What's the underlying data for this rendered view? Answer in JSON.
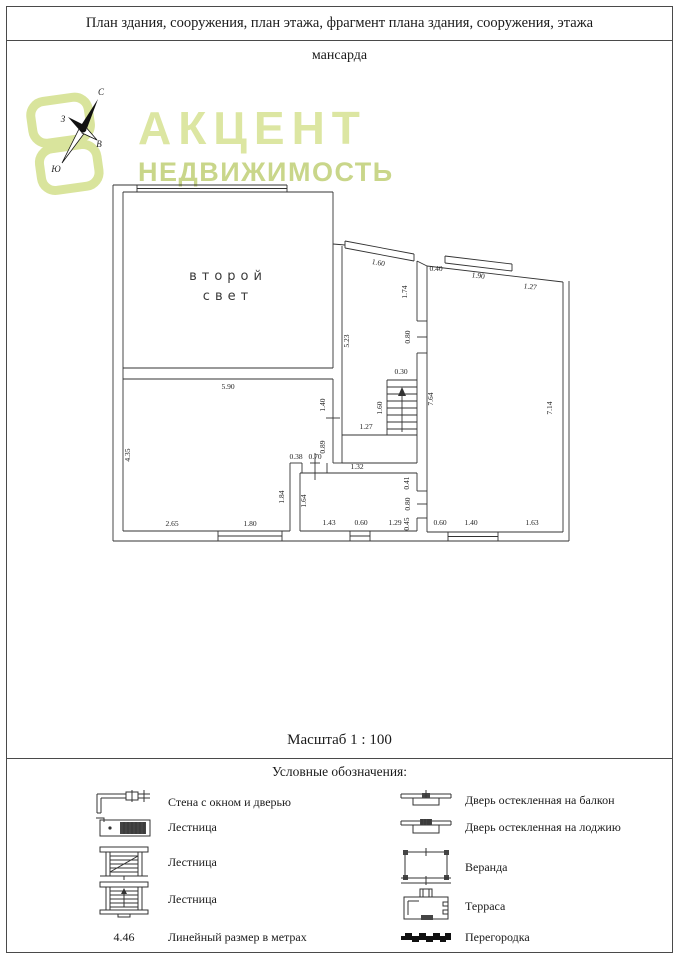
{
  "header": {
    "title": "План здания, сооружения, план этажа, фрагмент плана здания, сооружения, этажа"
  },
  "main": {
    "subtitle": "мансарда",
    "scale_label": "Масштаб 1 : 100"
  },
  "brand": {
    "line1": "АКЦЕНТ",
    "line2": "НЕДВИЖИМОСТЬ",
    "color_primary": "#dce6a2",
    "color_secondary": "#c9d68a"
  },
  "compass": {
    "north": "С",
    "west": "З",
    "east": "В",
    "south": "Ю"
  },
  "plan": {
    "line_color": "#333333",
    "room_label": {
      "line1": "второй",
      "line2": "свет"
    },
    "dims": [
      "5.90",
      "4.35",
      "2.65",
      "1.80",
      "1.60",
      "0.40",
      "1.90",
      "1.27",
      "1.74",
      "5.23",
      "0.80",
      "0.30",
      "1.60",
      "7.64",
      "7.14",
      "1.40",
      "1.27",
      "0.89",
      "0.38",
      "0.70",
      "1.84",
      "1.64",
      "1.32",
      "0.41",
      "0.80",
      "0.45",
      "1.43",
      "0.60",
      "1.29",
      "0.60",
      "1.40",
      "1.63"
    ]
  },
  "legend": {
    "title": "Условные обозначения:",
    "left": [
      {
        "icon": "wall-window-door-icon",
        "label": "Стена с окном и дверью"
      },
      {
        "icon": "staircase-icon",
        "label": "Лестница"
      },
      {
        "icon": "staircase-icon",
        "label": "Лестница"
      },
      {
        "icon": "staircase-icon",
        "label": "Лестница"
      },
      {
        "icon": "linear-dimension-sample",
        "value": "4.46",
        "label": "Линейный размер в метрах"
      }
    ],
    "right": [
      {
        "icon": "glazed-door-balcony-icon",
        "label": "Дверь остекленная на балкон"
      },
      {
        "icon": "glazed-door-loggia-icon",
        "label": "Дверь остекленная на лоджию"
      },
      {
        "icon": "veranda-icon",
        "label": "Веранда"
      },
      {
        "icon": "terrace-icon",
        "label": "Терраса"
      },
      {
        "icon": "partition-icon",
        "label": "Перегородка"
      }
    ]
  }
}
